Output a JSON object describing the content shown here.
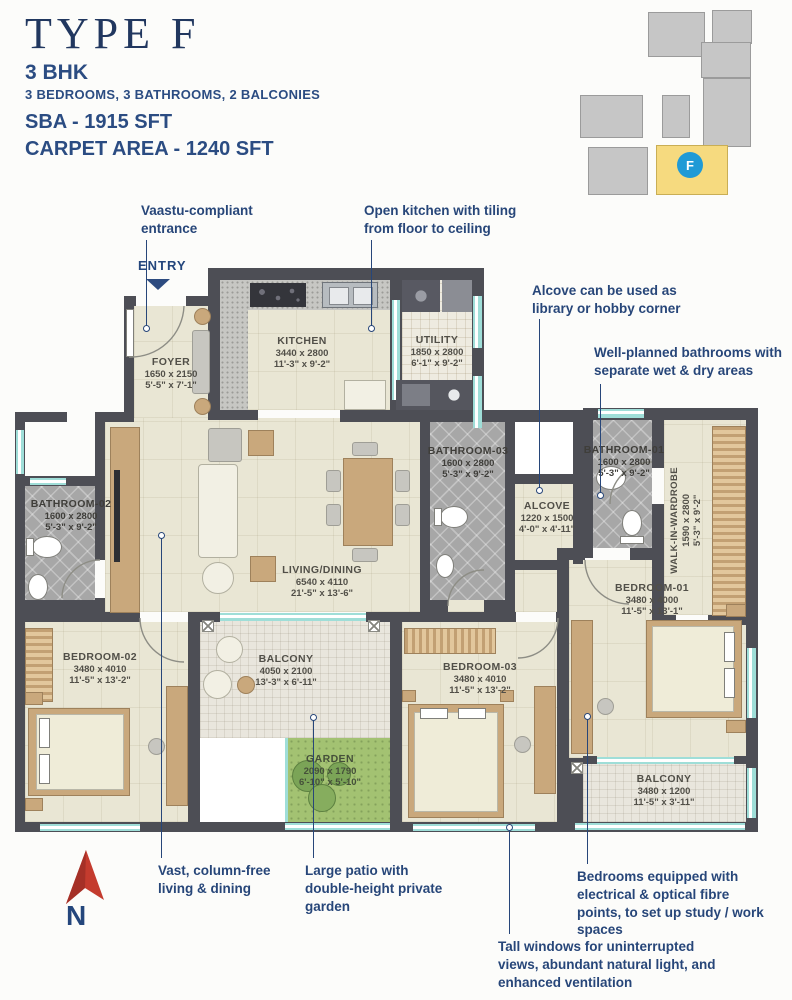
{
  "header": {
    "title": "TYPE F",
    "bhk": "3 BHK",
    "configuration": "3 BEDROOMS, 3 BATHROOMS, 2 BALCONIES",
    "sba": "SBA - 1915 SFT",
    "carpet_area": "CARPET AREA - 1240 SFT"
  },
  "key_plan": {
    "unit_label": "F"
  },
  "entry_label": "ENTRY",
  "north_label": "N",
  "annotations": {
    "vaastu": "Vaastu-compliant entrance",
    "kitchen": "Open kitchen with tiling from floor to ceiling",
    "alcove": "Alcove can be used as library or hobby corner",
    "bathrooms": "Well-planned bathrooms with separate wet & dry areas",
    "living": "Vast, column-free living & dining",
    "patio": "Large patio with double-height private garden",
    "bedrooms": "Bedrooms equipped with electrical & optical fibre points, to set up study / work spaces",
    "windows": "Tall windows for uninterrupted views, abundant natural light, and enhanced ventilation"
  },
  "rooms": {
    "foyer": {
      "name": "FOYER",
      "mm": "1650 x 2150",
      "ft": "5'-5\" x 7'-1\""
    },
    "kitchen": {
      "name": "KITCHEN",
      "mm": "3440 x 2800",
      "ft": "11'-3\" x 9'-2\""
    },
    "utility": {
      "name": "UTILITY",
      "mm": "1850 x 2800",
      "ft": "6'-1\" x 9'-2\""
    },
    "bathroom3": {
      "name": "BATHROOM-03",
      "mm": "1600 x 2800",
      "ft": "5'-3\" x 9'-2\""
    },
    "alcove": {
      "name": "ALCOVE",
      "mm": "1220 x 1500",
      "ft": "4'-0\" x 4'-11\""
    },
    "bathroom1": {
      "name": "BATHROOM-01",
      "mm": "1600 x 2800",
      "ft": "5'-3\" x 9'-2\""
    },
    "wardrobe": {
      "name": "WALK-IN-WARDROBE",
      "mm": "1590 x 2800",
      "ft": "5'-3\" x 9'-2\""
    },
    "bathroom2": {
      "name": "BATHROOM-02",
      "mm": "1600 x 2800",
      "ft": "5'-3\" x 9'-2\""
    },
    "living": {
      "name": "LIVING/DINING",
      "mm": "6540 x 4110",
      "ft": "21'-5\" x 13'-6\""
    },
    "bedroom1": {
      "name": "BEDROOM-01",
      "mm": "3480 x 4000",
      "ft": "11'-5\" x 13'-1\""
    },
    "bedroom2": {
      "name": "BEDROOM-02",
      "mm": "3480 x 4010",
      "ft": "11'-5\" x 13'-2\""
    },
    "bedroom3": {
      "name": "BEDROOM-03",
      "mm": "3480 x 4010",
      "ft": "11'-5\" x 13'-2\""
    },
    "balconyMain": {
      "name": "BALCONY",
      "mm": "4050 x 2100",
      "ft": "13'-3\" x 6'-11\""
    },
    "garden": {
      "name": "GARDEN",
      "mm": "2090 x 1790",
      "ft": "6'-10\" x 5'-10\""
    },
    "balconySmall": {
      "name": "BALCONY",
      "mm": "3480 x 1200",
      "ft": "11'-5\" x 3'-11\""
    }
  },
  "colors": {
    "annotation": "#274679",
    "walls": "#4d4e55",
    "key_plan_highlight": "#f6da7f",
    "key_plan_badge": "#1f9ad6",
    "north_arrow": "#c43b2e",
    "window": "#9fded8"
  }
}
